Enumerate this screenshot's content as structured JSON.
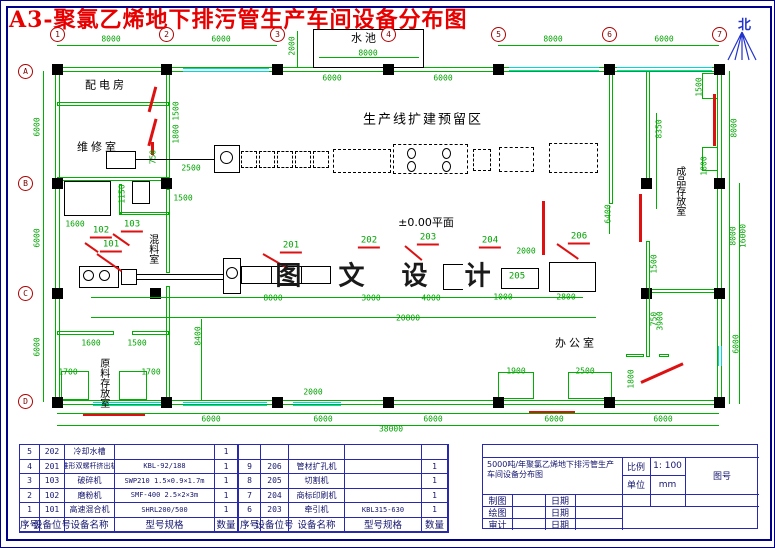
{
  "page": {
    "title": "A3-聚氯乙烯地下排污管生产车间设备分布图",
    "north_label": "北"
  },
  "colors": {
    "title_red": "#e80000",
    "wall_green": "#00b000",
    "window_cyan": "#00d9d9",
    "door_red": "#dd1111",
    "frame_blue": "#00008b"
  },
  "plan": {
    "watermark": "图 文 设 计",
    "level_label": "±0.00平面",
    "expansion_label": "生产线扩建预留区",
    "grid_cols": [
      {
        "label": "1",
        "x": 56
      },
      {
        "label": "2",
        "x": 165
      },
      {
        "label": "3",
        "x": 276
      },
      {
        "label": "4",
        "x": 387
      },
      {
        "label": "5",
        "x": 497
      },
      {
        "label": "6",
        "x": 608
      },
      {
        "label": "7",
        "x": 718
      }
    ],
    "grid_rows": [
      {
        "label": "A",
        "y": 70
      },
      {
        "label": "B",
        "y": 182
      },
      {
        "label": "C",
        "y": 292
      },
      {
        "label": "D",
        "y": 400
      }
    ],
    "rooms": [
      {
        "t": "配电房",
        "x": 105,
        "y": 85,
        "fs": 11,
        "v": 0
      },
      {
        "t": "维修室",
        "x": 97,
        "y": 147,
        "fs": 11,
        "v": 0
      },
      {
        "t": "水池",
        "x": 364,
        "y": 38,
        "fs": 11,
        "v": 0
      },
      {
        "t": "混料室",
        "x": 151,
        "y": 248,
        "fs": 10,
        "v": 1
      },
      {
        "t": "原料存放室",
        "x": 102,
        "y": 382,
        "fs": 10,
        "v": 1
      },
      {
        "t": "成品存放室",
        "x": 678,
        "y": 190,
        "fs": 10,
        "v": 1
      },
      {
        "t": "办公室",
        "x": 575,
        "y": 343,
        "fs": 11,
        "v": 0
      }
    ],
    "dims": [
      {
        "t": "8000",
        "x": 110,
        "y": 38
      },
      {
        "t": "6000",
        "x": 220,
        "y": 38
      },
      {
        "t": "8000",
        "x": 552,
        "y": 38
      },
      {
        "t": "6000",
        "x": 663,
        "y": 38
      },
      {
        "t": "2000",
        "x": 291,
        "y": 45,
        "v": 1
      },
      {
        "t": "8000",
        "x": 367,
        "y": 52
      },
      {
        "t": "6000",
        "x": 331,
        "y": 77
      },
      {
        "t": "6000",
        "x": 442,
        "y": 77
      },
      {
        "t": "6000",
        "x": 36,
        "y": 126,
        "v": 1
      },
      {
        "t": "6000",
        "x": 36,
        "y": 237,
        "v": 1
      },
      {
        "t": "6000",
        "x": 36,
        "y": 346,
        "v": 1
      },
      {
        "t": "1500",
        "x": 175,
        "y": 110,
        "v": 1
      },
      {
        "t": "1800",
        "x": 175,
        "y": 133,
        "v": 1
      },
      {
        "t": "750",
        "x": 152,
        "y": 156,
        "v": 1
      },
      {
        "t": "2500",
        "x": 190,
        "y": 167
      },
      {
        "t": "1150",
        "x": 121,
        "y": 193,
        "v": 1
      },
      {
        "t": "1600",
        "x": 74,
        "y": 223
      },
      {
        "t": "1500",
        "x": 182,
        "y": 197
      },
      {
        "t": "8400",
        "x": 197,
        "y": 335,
        "v": 1
      },
      {
        "t": "1600",
        "x": 90,
        "y": 342
      },
      {
        "t": "1500",
        "x": 136,
        "y": 342
      },
      {
        "t": "1700",
        "x": 67,
        "y": 371
      },
      {
        "t": "1700",
        "x": 150,
        "y": 371
      },
      {
        "t": "8000",
        "x": 272,
        "y": 297
      },
      {
        "t": "3000",
        "x": 370,
        "y": 297
      },
      {
        "t": "4000",
        "x": 430,
        "y": 297
      },
      {
        "t": "1000",
        "x": 502,
        "y": 296
      },
      {
        "t": "2800",
        "x": 565,
        "y": 296
      },
      {
        "t": "20800",
        "x": 407,
        "y": 317
      },
      {
        "t": "2000",
        "x": 525,
        "y": 250
      },
      {
        "t": "6400",
        "x": 607,
        "y": 213,
        "v": 1
      },
      {
        "t": "8350",
        "x": 658,
        "y": 128,
        "v": 1
      },
      {
        "t": "1500",
        "x": 698,
        "y": 86,
        "v": 1
      },
      {
        "t": "8000",
        "x": 733,
        "y": 127,
        "v": 1
      },
      {
        "t": "1800",
        "x": 703,
        "y": 165,
        "v": 1
      },
      {
        "t": "1500",
        "x": 653,
        "y": 263,
        "v": 1
      },
      {
        "t": "750",
        "x": 653,
        "y": 318,
        "v": 1
      },
      {
        "t": "8000",
        "x": 732,
        "y": 235,
        "v": 1
      },
      {
        "t": "16000",
        "x": 742,
        "y": 235,
        "v": 1
      },
      {
        "t": "3900",
        "x": 659,
        "y": 320,
        "v": 1
      },
      {
        "t": "1800",
        "x": 630,
        "y": 378,
        "v": 1
      },
      {
        "t": "6000",
        "x": 735,
        "y": 343,
        "v": 1
      },
      {
        "t": "1900",
        "x": 515,
        "y": 370
      },
      {
        "t": "2500",
        "x": 584,
        "y": 370
      },
      {
        "t": "2000",
        "x": 312,
        "y": 391
      },
      {
        "t": "6000",
        "x": 210,
        "y": 418
      },
      {
        "t": "6000",
        "x": 322,
        "y": 418
      },
      {
        "t": "6000",
        "x": 432,
        "y": 418
      },
      {
        "t": "6000",
        "x": 553,
        "y": 418
      },
      {
        "t": "6000",
        "x": 662,
        "y": 418
      },
      {
        "t": "38000",
        "x": 390,
        "y": 428
      }
    ],
    "callouts": [
      {
        "t": "101",
        "x": 110,
        "y": 245
      },
      {
        "t": "102",
        "x": 100,
        "y": 231
      },
      {
        "t": "103",
        "x": 131,
        "y": 225
      },
      {
        "t": "201",
        "x": 290,
        "y": 246
      },
      {
        "t": "202",
        "x": 368,
        "y": 241
      },
      {
        "t": "203",
        "x": 427,
        "y": 238
      },
      {
        "t": "204",
        "x": 489,
        "y": 241
      },
      {
        "t": "205",
        "x": 516,
        "y": 276,
        "nl": 1
      },
      {
        "t": "206",
        "x": 578,
        "y": 237
      }
    ]
  },
  "equipment_table": {
    "headers": [
      "序号",
      "设备位号",
      "设备名称",
      "型号规格",
      "数量"
    ],
    "left_rows": [
      [
        "5",
        "202",
        "冷却水槽",
        "",
        "1"
      ],
      [
        "4",
        "201",
        "锥形双螺杆挤出机",
        "KBL-92/188",
        "1"
      ],
      [
        "3",
        "103",
        "破碎机",
        "SWP210 1.5×0.9×1.7m",
        "1"
      ],
      [
        "2",
        "102",
        "磨粉机",
        "SMF-400 2.5×2×3m",
        "1"
      ],
      [
        "1",
        "101",
        "高速混合机",
        "SHRL200/500",
        "1"
      ]
    ],
    "right_rows": [
      [
        "",
        "",
        "",
        "",
        ""
      ],
      [
        "9",
        "206",
        "管材扩孔机",
        "",
        "1"
      ],
      [
        "8",
        "205",
        "切割机",
        "",
        "1"
      ],
      [
        "7",
        "204",
        "商标印刷机",
        "",
        "1"
      ],
      [
        "6",
        "203",
        "牵引机",
        "KBL315-630",
        "1"
      ]
    ]
  },
  "title_block": {
    "project_title": "5000吨/年聚氯乙烯地下排污管生产车间设备分布图",
    "scale_label": "比例",
    "scale_value": "1: 100",
    "unit_label": "单位",
    "unit_value": "mm",
    "drawing_no_label": "图号",
    "rows": [
      {
        "label": "制图",
        "date_label": "日期"
      },
      {
        "label": "绘图",
        "date_label": "日期"
      },
      {
        "label": "审计",
        "date_label": "日期"
      }
    ]
  }
}
